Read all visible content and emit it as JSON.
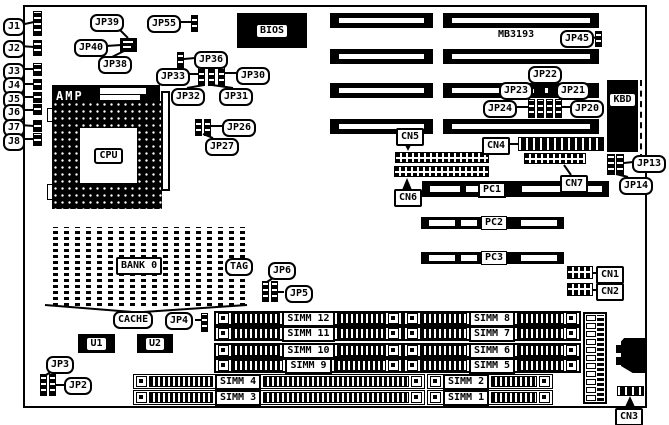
{
  "diagram": {
    "model": "MB3193"
  },
  "labels": {
    "j1": "J1",
    "j2": "J2",
    "j3": "J3",
    "j4": "J4",
    "j5": "J5",
    "j6": "J6",
    "j7": "J7",
    "j8": "J8",
    "jp39": "JP39",
    "jp40": "JP40",
    "jp38": "JP38",
    "jp55": "JP55",
    "jp36": "JP36",
    "jp33": "JP33",
    "jp30": "JP30",
    "jp32": "JP32",
    "jp31": "JP31",
    "jp26": "JP26",
    "jp27": "JP27",
    "bios": "BIOS",
    "amp": "AMP",
    "cpu": "CPU",
    "model": "MB3193",
    "jp45": "JP45",
    "jp22": "JP22",
    "jp23": "JP23",
    "jp21": "JP21",
    "jp24": "JP24",
    "jp20": "JP20",
    "kbd": "KBD",
    "jp13": "JP13",
    "jp14": "JP14",
    "cn1": "CN1",
    "cn2": "CN2",
    "cn3": "CN3",
    "cn4": "CN4",
    "cn5": "CN5",
    "cn6": "CN6",
    "cn7": "CN7",
    "pc1": "PC1",
    "pc2": "PC2",
    "pc3": "PC3",
    "bank0": "BANK 0",
    "tag": "TAG",
    "cache": "CACHE",
    "jp6": "JP6",
    "jp5": "JP5",
    "jp4": "JP4",
    "jp3": "JP3",
    "jp2": "JP2",
    "u1": "U1",
    "u2": "U2",
    "simm1": "SIMM 1",
    "simm2": "SIMM 2",
    "simm3": "SIMM 3",
    "simm4": "SIMM 4",
    "simm5": "SIMM 5",
    "simm6": "SIMM 6",
    "simm7": "SIMM 7",
    "simm8": "SIMM 8",
    "simm9": "SIMM 9",
    "simm10": "SIMM 10",
    "simm11": "SIMM 11",
    "simm12": "SIMM 12"
  }
}
